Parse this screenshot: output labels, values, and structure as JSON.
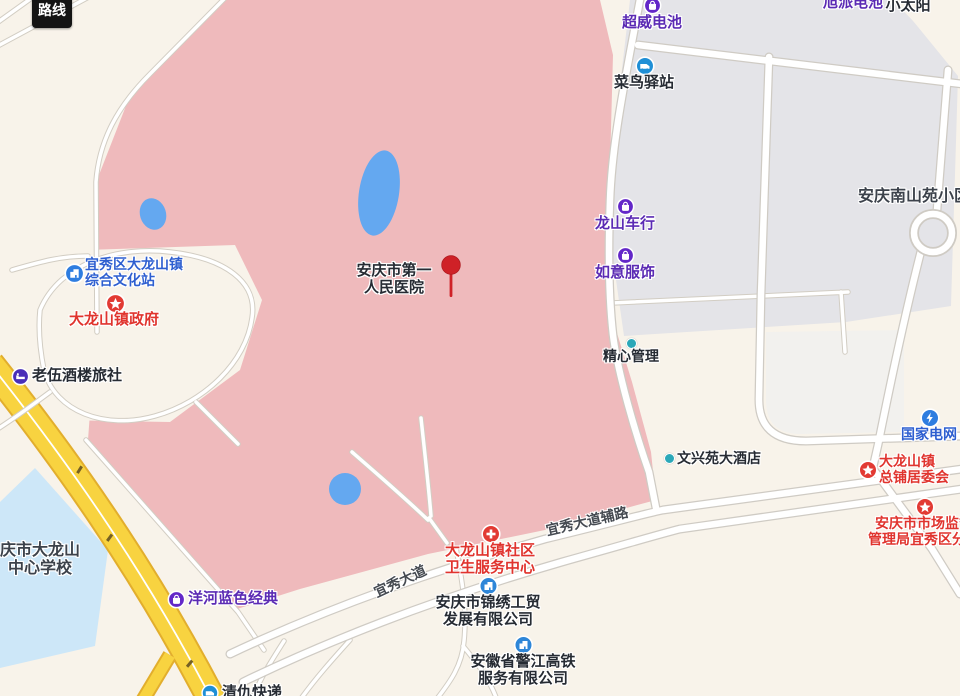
{
  "route_button": {
    "label": "路线"
  },
  "pois": {
    "chaowei": {
      "name": "超威电池"
    },
    "xupai": {
      "name": "旭派电池"
    },
    "xiaotaiyang": {
      "name": "小太阳"
    },
    "cainiao": {
      "name": "菜鸟驿站"
    },
    "nanshanyuan": {
      "name": "安庆南山苑小区"
    },
    "longshan_bike": {
      "name": "龙山车行"
    },
    "ruyi": {
      "name": "如意服饰"
    },
    "jingxin": {
      "name": "精心管理"
    },
    "wenhuazhan": {
      "line1": "宜秀区大龙山镇",
      "line2": "综合文化站"
    },
    "zhengfu": {
      "name": "大龙山镇政府"
    },
    "laowu": {
      "name": "老伍酒楼旅社"
    },
    "hospital": {
      "line1": "安庆市第一",
      "line2": "人民医院"
    },
    "wenxingyuan": {
      "name": "文兴苑大酒店"
    },
    "guowang": {
      "name": "国家电网"
    },
    "zongpu": {
      "line1": "大龙山镇",
      "line2": "总铺居委会"
    },
    "shichang": {
      "line1": "安庆市市场监督",
      "line2": "管理局宜秀区分局"
    },
    "school": {
      "line1": "庆市大龙山",
      "line2": "中心学校"
    },
    "yanghe": {
      "name": "洋河蓝色经典"
    },
    "weisheng": {
      "line1": "大龙山镇社区",
      "line2": "卫生服务中心"
    },
    "jinxiu": {
      "line1": "安庆市锦绣工贸",
      "line2": "发展有限公司"
    },
    "gaotie": {
      "line1": "安徽省警江高铁",
      "line2": "服务有限公司"
    },
    "express": {
      "name": "清仇快递"
    }
  },
  "roads": {
    "yixiu_avenue": "宜秀大道",
    "yixiu_side_road": "宜秀大道辅路"
  },
  "colors": {
    "background": "#f8f3ea",
    "hospital_grounds_pink": "#efbabc",
    "residential_gray": "#e4e4e8",
    "school_blue": "#cde7f8",
    "water_blue": "#64a8f0",
    "road_yellow": "#f8d340",
    "poi_purple": "#6327c8",
    "poi_red": "#e23a33",
    "poi_blue": "#2e7de0",
    "pin_red": "#cf2127"
  }
}
